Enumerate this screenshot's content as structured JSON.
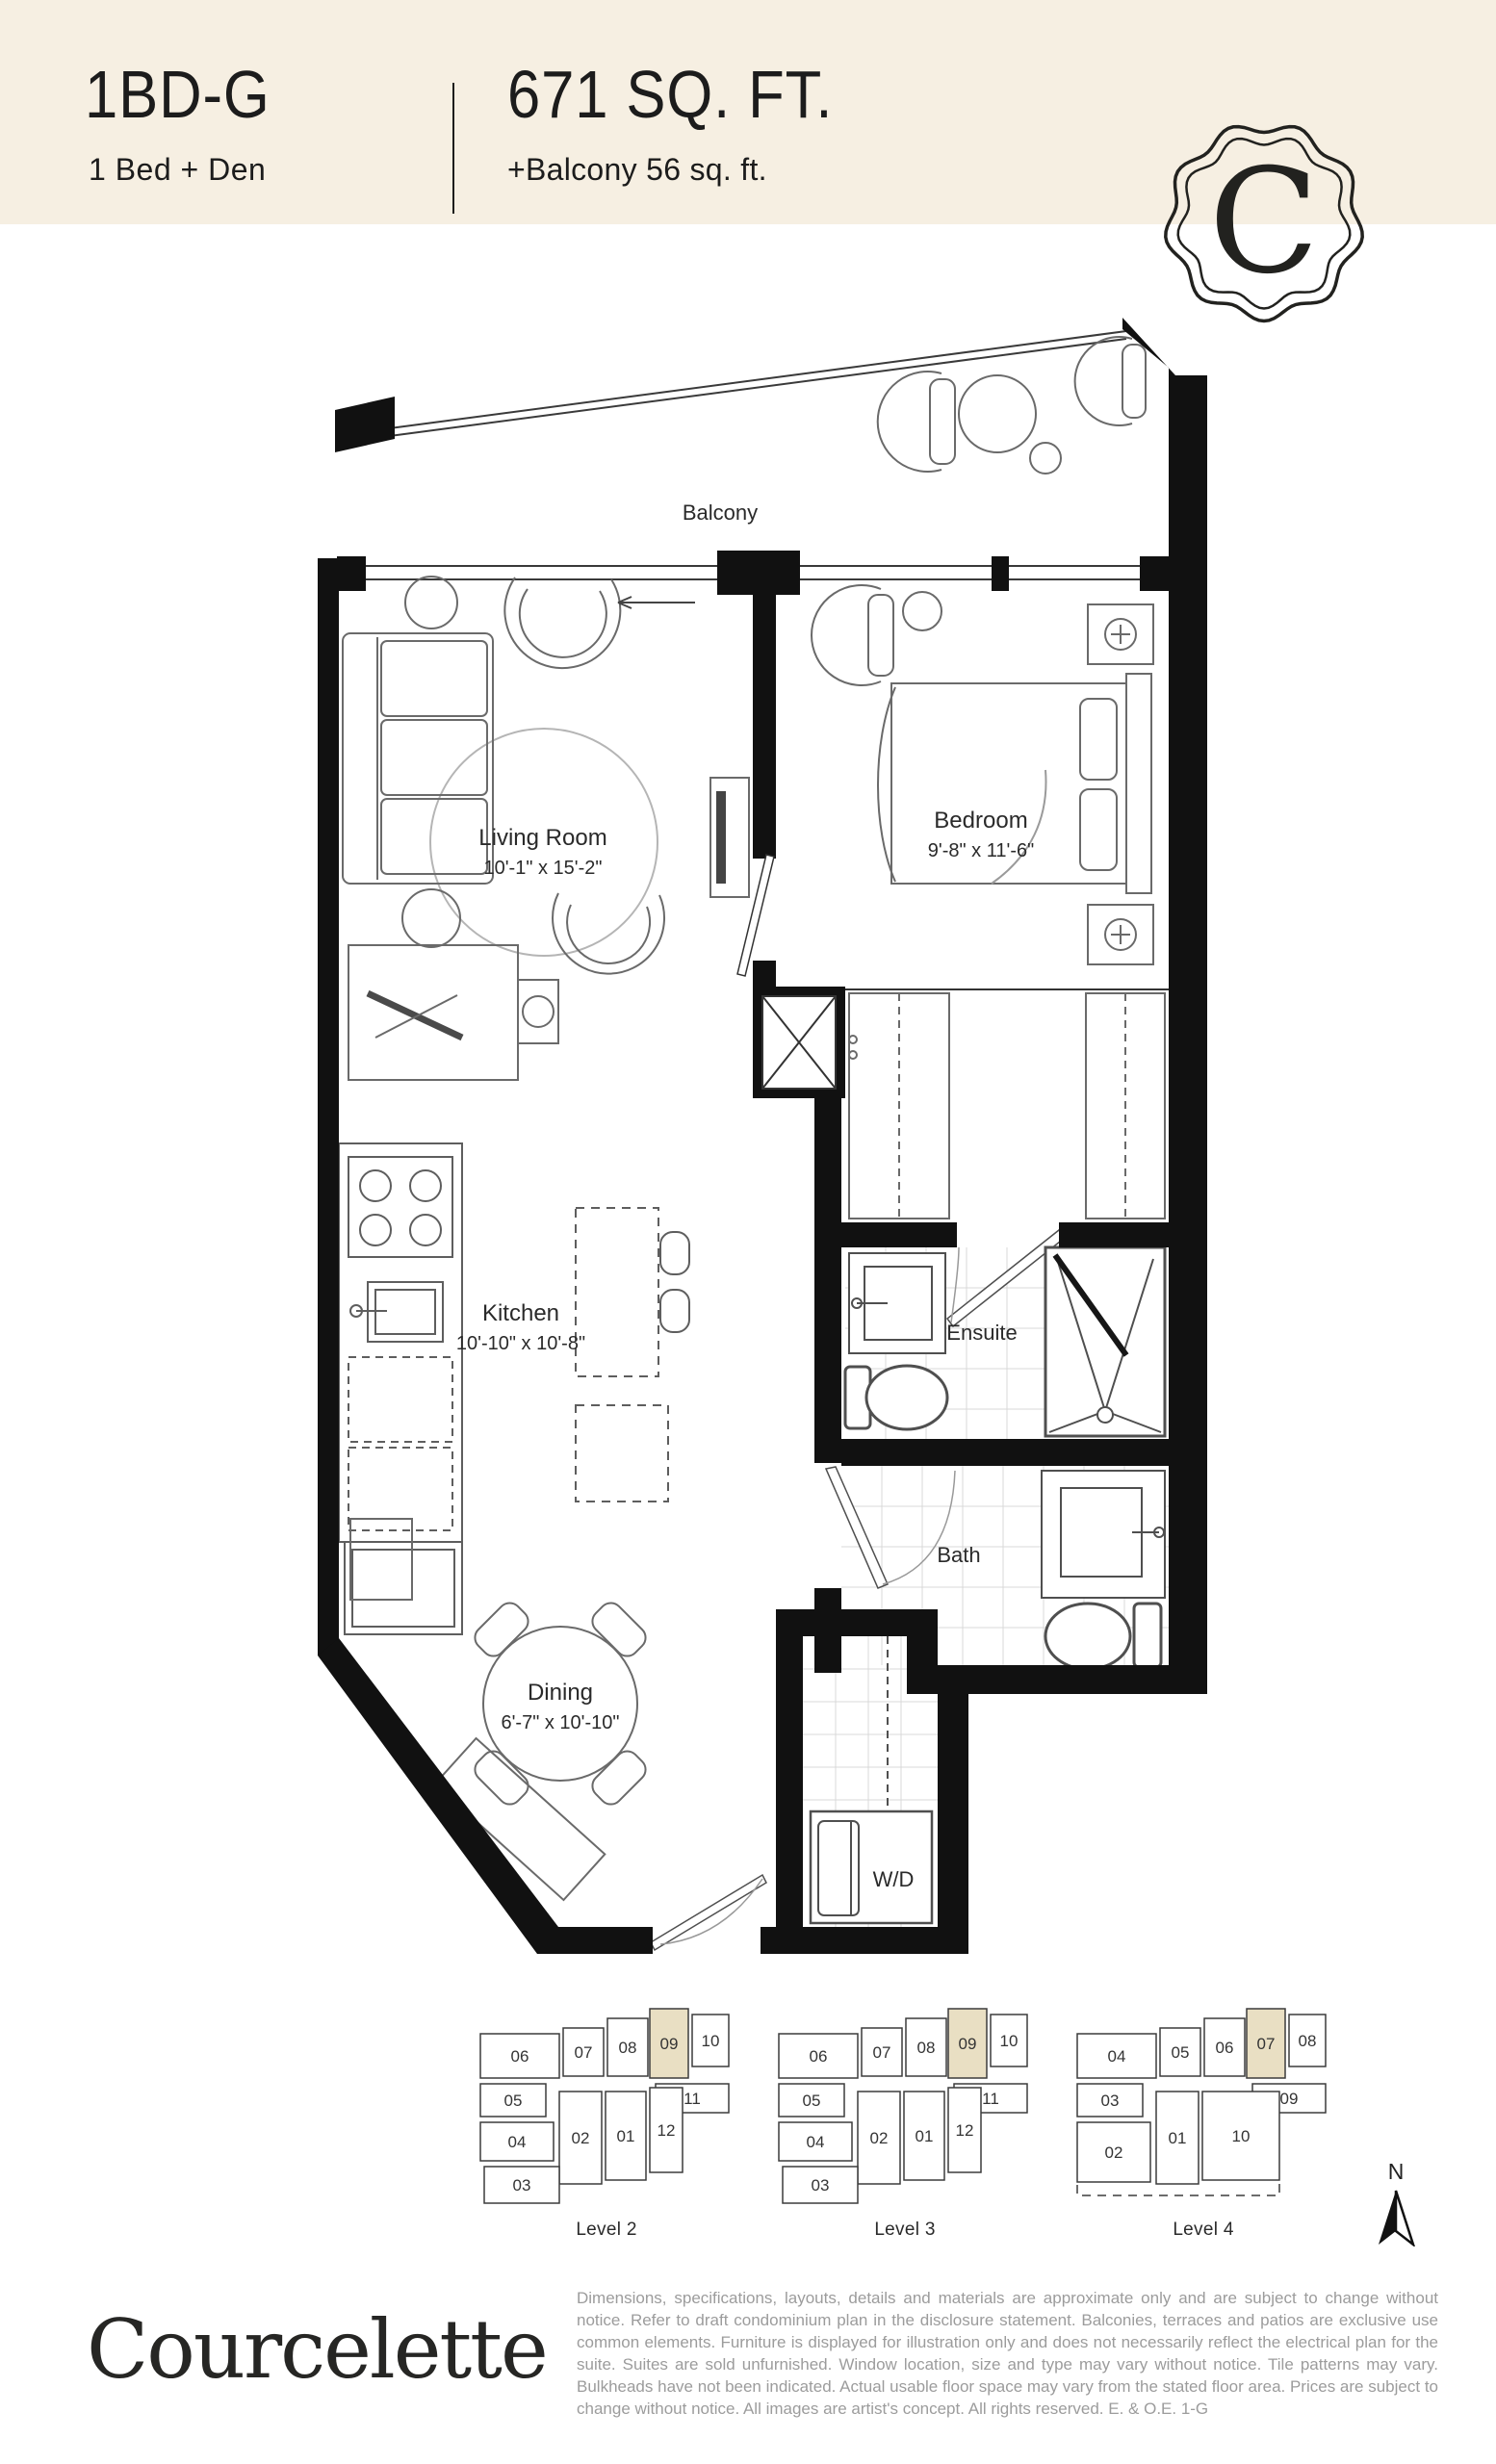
{
  "header": {
    "plan_code": "1BD-G",
    "plan_type": "1 Bed + Den",
    "area": "671 SQ. FT.",
    "balcony": "+Balcony 56 sq. ft.",
    "badge_letter": "C"
  },
  "floorplan": {
    "rooms": {
      "balcony": {
        "name": "Balcony"
      },
      "living": {
        "name": "Living Room",
        "dims": "10'-1\" x 15'-2\""
      },
      "bedroom": {
        "name": "Bedroom",
        "dims": "9'-8\" x 11'-6\""
      },
      "kitchen": {
        "name": "Kitchen",
        "dims": "10'-10\" x 10'-8\""
      },
      "ensuite": {
        "name": "Ensuite"
      },
      "bath": {
        "name": "Bath"
      },
      "dining": {
        "name": "Dining",
        "dims": "6'-7\" x 10'-10\""
      },
      "laundry": {
        "name": "W/D"
      }
    }
  },
  "keyplans": [
    {
      "label": "Level 2",
      "layout": "L12",
      "highlight": "09",
      "units": [
        "06",
        "07",
        "08",
        "09",
        "10",
        "05",
        "11",
        "04",
        "02",
        "01",
        "12",
        "03"
      ]
    },
    {
      "label": "Level 3",
      "layout": "L12",
      "highlight": "09",
      "units": [
        "06",
        "07",
        "08",
        "09",
        "10",
        "05",
        "11",
        "04",
        "02",
        "01",
        "12",
        "03"
      ]
    },
    {
      "label": "Level 4",
      "layout": "L10",
      "highlight": "07",
      "units": [
        "04",
        "05",
        "06",
        "07",
        "08",
        "03",
        "09",
        "02",
        "01",
        "10"
      ]
    }
  ],
  "compass": {
    "label": "N"
  },
  "brand": {
    "wordmark": "Courcelette"
  },
  "colors": {
    "cream": "#f6efe2",
    "wall": "#111111",
    "highlight": "#e9dfc3",
    "disclaimer_gray": "#9c9c9c"
  },
  "disclaimer": "Dimensions, specifications, layouts, details and materials are approximate only and are subject to change without notice. Refer to draft condominium plan in the disclosure statement. Balconies, terraces and patios are exclusive use common elements. Furniture is displayed for illustration only and does not necessarily reflect the electrical plan for the suite. Suites are sold unfurnished. Window location, size and type may vary without notice. Tile patterns may vary.  Bulkheads have not been indicated. Actual usable floor space may vary from the stated floor area. Prices are subject to change without notice. All images are artist's concept. All rights reserved. E. & O.E.  1-G"
}
